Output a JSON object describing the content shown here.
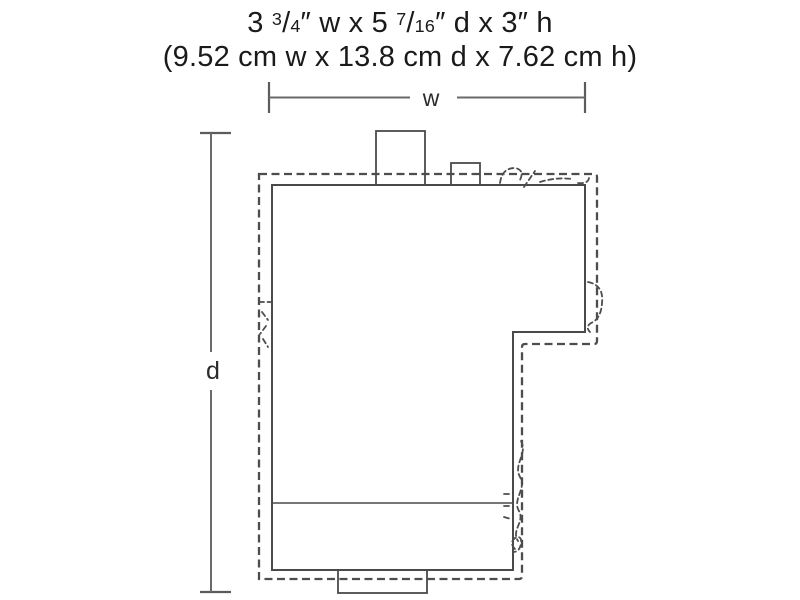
{
  "title": {
    "imperial": {
      "seg1": "3 ",
      "frac1_num": "3",
      "frac1_slash": "/",
      "frac1_den": "4",
      "seg2": "″ w x 5 ",
      "frac2_num": "7",
      "frac2_slash": "/",
      "frac2_den": "16",
      "seg3": "″ d x 3″ h"
    },
    "metric": "(9.52 cm w x 13.8 cm d x 7.62 cm h)"
  },
  "dimension_labels": {
    "width": "w",
    "depth": "d"
  },
  "colors": {
    "footprint_fill": "#d2d2d2",
    "solid_outline": "#4a4a4a",
    "dashed_outline": "#4d4d4d",
    "dimension_line": "#6a6a6a",
    "text": "#1a1a1a"
  }
}
